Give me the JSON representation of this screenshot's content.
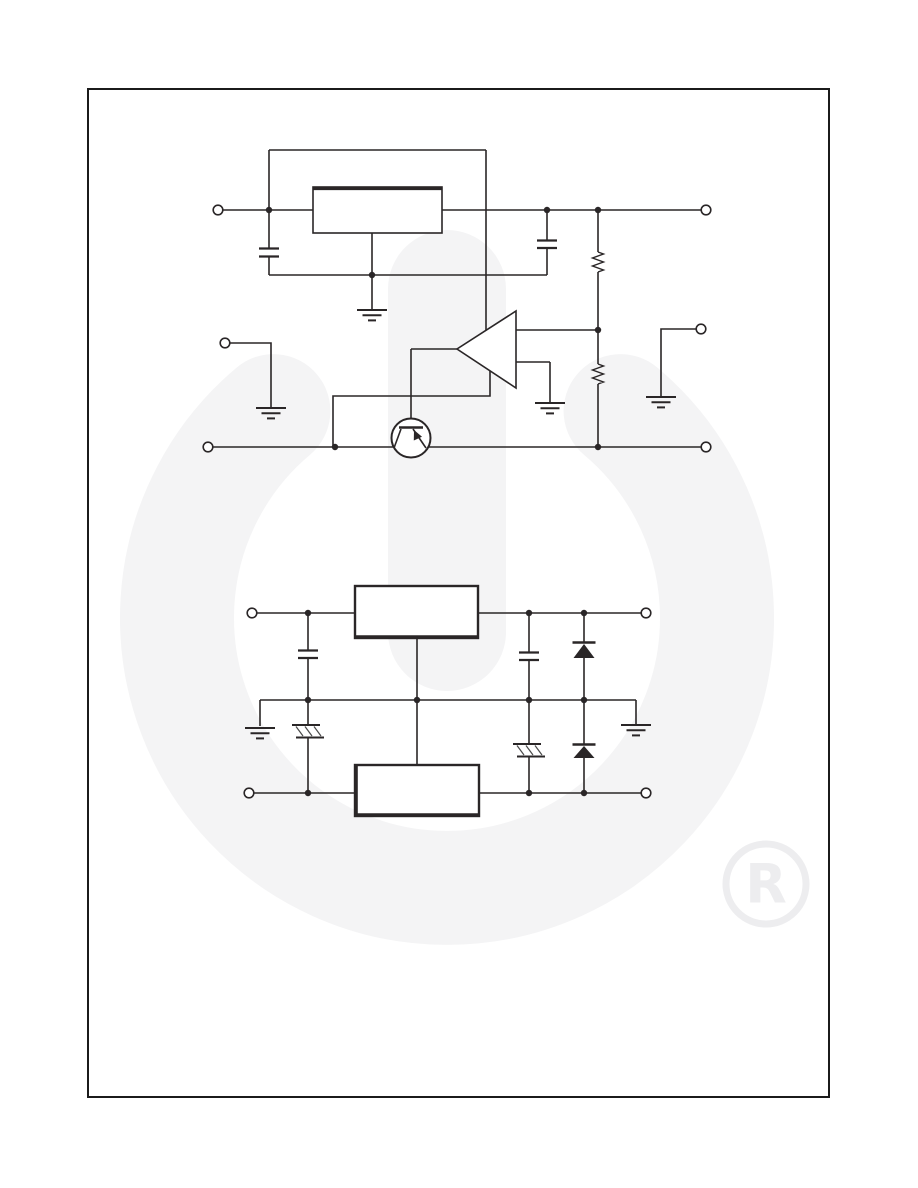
{
  "page": {
    "width": 918,
    "height": 1188,
    "background": "#ffffff",
    "frame_color": "#1b1b1b",
    "line_color": "#2a2627",
    "fill_color": "#ffffff",
    "watermark_color": "#f4f4f5",
    "registered_color": "#ededef",
    "registered_symbol": "R"
  },
  "frame": {
    "x": 88,
    "y": 89,
    "w": 741,
    "h": 1008,
    "stroke_width": 2
  },
  "watermark": {
    "arc": {
      "x1": 273.4,
      "y1": 411.1,
      "x2": 620.6,
      "y2": 411.1,
      "r": 270,
      "stroke_width": 114
    },
    "stem": {
      "x": 447,
      "y1": 289,
      "y2": 632,
      "stroke_width": 118
    },
    "registered": {
      "cx": 766,
      "cy": 884,
      "r": 40,
      "stroke_width": 7,
      "font_size": 54
    }
  },
  "schematic": {
    "stroke_width": 1.6,
    "wires": [
      [
        [
          223,
          210
        ],
        [
          313,
          210
        ]
      ],
      [
        [
          442,
          210
        ],
        [
          701,
          210
        ]
      ],
      [
        [
          269,
          150
        ],
        [
          486,
          150
        ]
      ],
      [
        [
          269,
          150
        ],
        [
          269,
          248
        ]
      ],
      [
        [
          486,
          150
        ],
        [
          486,
          330
        ]
      ],
      [
        [
          269,
          257
        ],
        [
          269,
          275
        ]
      ],
      [
        [
          269,
          275
        ],
        [
          547,
          275
        ]
      ],
      [
        [
          372,
          233
        ],
        [
          372,
          275
        ]
      ],
      [
        [
          372,
          275
        ],
        [
          372,
          309
        ]
      ],
      [
        [
          547,
          210
        ],
        [
          547,
          240
        ]
      ],
      [
        [
          547,
          248
        ],
        [
          547,
          275
        ]
      ],
      [
        [
          598,
          210
        ],
        [
          598,
          252
        ]
      ],
      [
        [
          598,
          272
        ],
        [
          598,
          330
        ]
      ],
      [
        [
          598,
          330
        ],
        [
          598,
          364
        ]
      ],
      [
        [
          598,
          384
        ],
        [
          598,
          447
        ]
      ],
      [
        [
          516,
          330
        ],
        [
          598,
          330
        ]
      ],
      [
        [
          516,
          362
        ],
        [
          550,
          362
        ]
      ],
      [
        [
          550,
          362
        ],
        [
          550,
          402
        ]
      ],
      [
        [
          457,
          349
        ],
        [
          411,
          349
        ]
      ],
      [
        [
          411,
          349
        ],
        [
          411,
          420
        ]
      ],
      [
        [
          490,
          371
        ],
        [
          490,
          396
        ],
        [
          333,
          396
        ],
        [
          333,
          447
        ]
      ],
      [
        [
          213,
          447
        ],
        [
          701,
          447
        ]
      ],
      [
        [
          230,
          343
        ],
        [
          271,
          343
        ],
        [
          271,
          407
        ]
      ],
      [
        [
          696,
          329
        ],
        [
          661,
          329
        ],
        [
          661,
          396
        ]
      ],
      [
        [
          257,
          613
        ],
        [
          355,
          613
        ]
      ],
      [
        [
          478,
          613
        ],
        [
          641,
          613
        ]
      ],
      [
        [
          308,
          613
        ],
        [
          308,
          650
        ]
      ],
      [
        [
          308,
          658
        ],
        [
          308,
          700
        ]
      ],
      [
        [
          260,
          700
        ],
        [
          636,
          700
        ]
      ],
      [
        [
          260,
          700
        ],
        [
          260,
          726
        ]
      ],
      [
        [
          636,
          700
        ],
        [
          636,
          724
        ]
      ],
      [
        [
          417,
          638
        ],
        [
          417,
          764
        ]
      ],
      [
        [
          308,
          700
        ],
        [
          308,
          725
        ]
      ],
      [
        [
          308,
          738
        ],
        [
          308,
          793
        ]
      ],
      [
        [
          254,
          793
        ],
        [
          355,
          793
        ]
      ],
      [
        [
          478,
          793
        ],
        [
          641,
          793
        ]
      ],
      [
        [
          529,
          613
        ],
        [
          529,
          652
        ]
      ],
      [
        [
          529,
          660
        ],
        [
          529,
          700
        ]
      ],
      [
        [
          529,
          700
        ],
        [
          529,
          744
        ]
      ],
      [
        [
          529,
          756
        ],
        [
          529,
          793
        ]
      ],
      [
        [
          584,
          613
        ],
        [
          584,
          642
        ]
      ],
      [
        [
          584,
          658
        ],
        [
          584,
          700
        ]
      ],
      [
        [
          584,
          700
        ],
        [
          584,
          744
        ]
      ],
      [
        [
          584,
          758
        ],
        [
          584,
          793
        ]
      ]
    ],
    "boxes": [
      {
        "x": 313,
        "y": 187,
        "w": 129,
        "h": 46,
        "stroke_width": 1.6
      },
      {
        "x": 355,
        "y": 586,
        "w": 123,
        "h": 52,
        "stroke_width": 2.4
      },
      {
        "x": 355,
        "y": 765,
        "w": 124,
        "h": 51,
        "stroke_width": 2.4
      }
    ],
    "thick_edges": [
      [
        [
          313,
          188.5
        ],
        [
          442,
          188.5
        ]
      ],
      [
        [
          355,
          636.8
        ],
        [
          478,
          636.8
        ]
      ],
      [
        [
          356.2,
          765
        ],
        [
          356.2,
          816
        ]
      ],
      [
        [
          355,
          814.8
        ],
        [
          479,
          814.8
        ]
      ]
    ],
    "opamp": {
      "points": [
        [
          516,
          311
        ],
        [
          516,
          388
        ],
        [
          457,
          349
        ]
      ]
    },
    "transistor": {
      "cx": 411,
      "cy": 438,
      "r": 19.5,
      "base_bar": [
        [
          399,
          427.5
        ],
        [
          423,
          427.5
        ]
      ],
      "legs": [
        [
          [
            401,
            429
          ],
          [
            394,
            448
          ]
        ],
        [
          [
            413,
            429
          ],
          [
            426,
            448
          ]
        ]
      ],
      "arrow": [
        [
          414,
          430
        ],
        [
          422,
          436.8
        ],
        [
          413.8,
          440.5
        ]
      ]
    },
    "capacitors": [
      {
        "x": 269,
        "y1": 248.5,
        "y2": 256.5,
        "half_w": 10
      },
      {
        "x": 547,
        "y1": 240.5,
        "y2": 248,
        "half_w": 10
      },
      {
        "x": 308,
        "y1": 650.5,
        "y2": 658,
        "half_w": 10
      },
      {
        "x": 529,
        "y1": 652.5,
        "y2": 660,
        "half_w": 10
      }
    ],
    "resistors": [
      {
        "x": 598,
        "y1": 252,
        "y2": 272,
        "amp": 5.5
      },
      {
        "x": 598,
        "y1": 364,
        "y2": 384,
        "amp": 5.5
      }
    ],
    "grounds": [
      {
        "x": 372,
        "y": 310
      },
      {
        "x": 550,
        "y": 403
      },
      {
        "x": 271,
        "y": 408
      },
      {
        "x": 661,
        "y": 397
      },
      {
        "x": 260,
        "y": 728
      },
      {
        "x": 636,
        "y": 725
      }
    ],
    "ground_style": {
      "widths": [
        30,
        19,
        8
      ],
      "gap": 5.2,
      "stroke_width": 2
    },
    "hatches": [
      {
        "x": 308,
        "y": 725
      },
      {
        "x": 529,
        "y": 744
      }
    ],
    "hatch_style": {
      "bar_stroke": 2,
      "diag_stroke": 1.2,
      "diag_color": "#4a4a4a"
    },
    "diodes": [
      {
        "x": 584,
        "bar_y": 642.5,
        "tri_top": 644,
        "tri_bot": 658,
        "half_w": 11.5
      },
      {
        "x": 584,
        "bar_y": 744.5,
        "tri_top": 746,
        "tri_bot": 758,
        "half_w": 11.5
      }
    ],
    "dots": [
      [
        269,
        210
      ],
      [
        547,
        210
      ],
      [
        598,
        210
      ],
      [
        372,
        275
      ],
      [
        598,
        330
      ],
      [
        335,
        447
      ],
      [
        598,
        447
      ],
      [
        308,
        613
      ],
      [
        529,
        613
      ],
      [
        584,
        613
      ],
      [
        308,
        700
      ],
      [
        417,
        700
      ],
      [
        529,
        700
      ],
      [
        584,
        700
      ],
      [
        308,
        793
      ],
      [
        529,
        793
      ],
      [
        584,
        793
      ]
    ],
    "dot_radius": 3.2,
    "terminals": [
      [
        218,
        210
      ],
      [
        706,
        210
      ],
      [
        225,
        343
      ],
      [
        701,
        329
      ],
      [
        208,
        447
      ],
      [
        706,
        447
      ],
      [
        252,
        613
      ],
      [
        646,
        613
      ],
      [
        249,
        793
      ],
      [
        646,
        793
      ]
    ],
    "terminal_radius": 4.8
  }
}
